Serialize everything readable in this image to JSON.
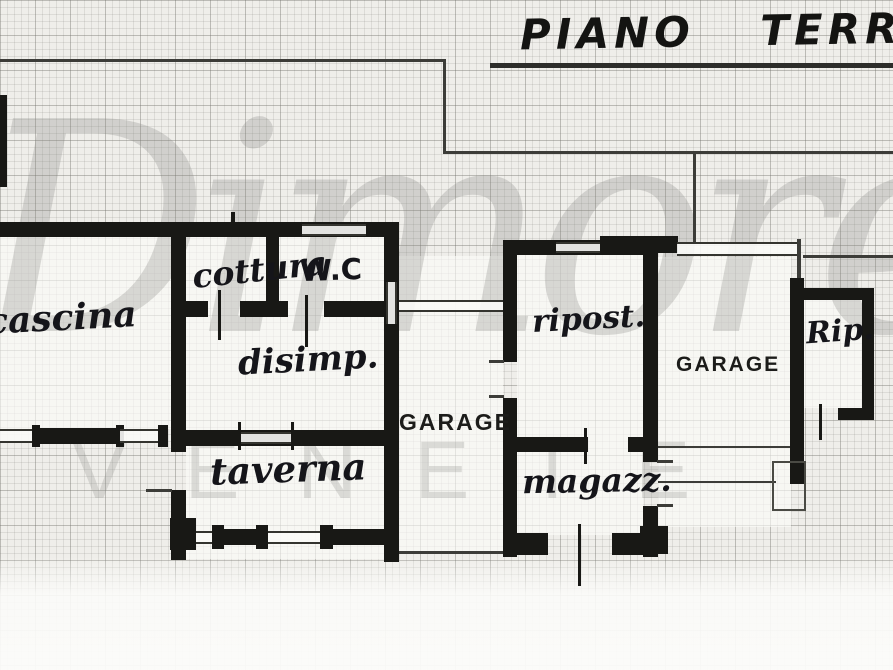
{
  "title": "PIANO TERRA",
  "watermark": {
    "primary": "Dimore",
    "secondary": "VENETE"
  },
  "labels": {
    "cascina": "cascina",
    "cottura": "cottura",
    "wc": "W.C",
    "disimpegno": "disimp.",
    "taverna": "taverna",
    "garage_main": "GARAGE",
    "ripostiglio": "ripost.",
    "magazzino": "magazz.",
    "garage_right": "GARAGE",
    "rip_small": "Rip."
  },
  "colors": {
    "ink": "#181815",
    "paper": "#efeeea",
    "grid_line": "#a9a9a2",
    "watermark_gray": "#b9b9b5"
  }
}
